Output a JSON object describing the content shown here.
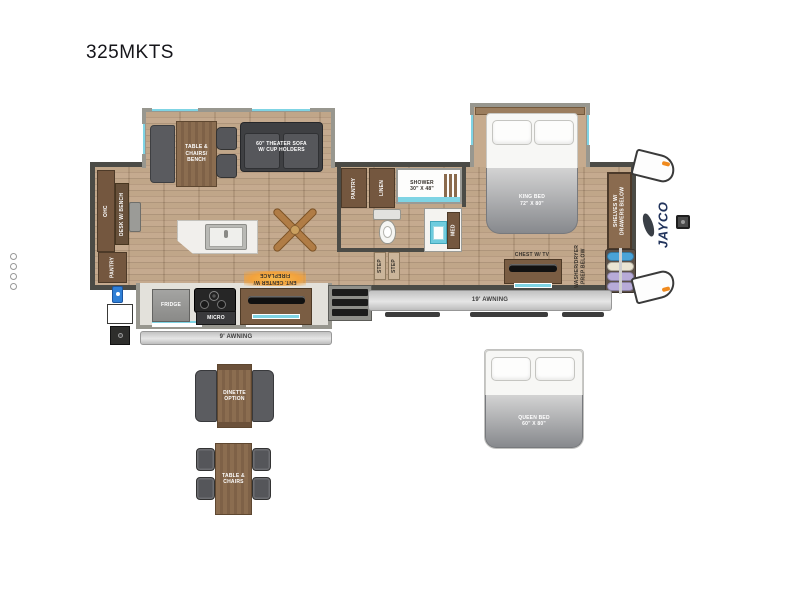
{
  "title": "325MKTS",
  "plan": {
    "living_slide": {
      "table_label": "TABLE &\nCHAIRS/\nBENCH",
      "sofa_label": "60\" THEATER SOFA\nW/ CUP HOLDERS"
    },
    "rear": {
      "ohc_label": "OHC",
      "desk_label": "DESK W/ BENCH",
      "pantry_label": "PANTRY"
    },
    "kitchen": {
      "fridge_label": "FRIDGE",
      "micro_label": "MICRO",
      "ent_center_label": "ENT. CENTER W/\nFIREPLACE",
      "awning_label": "9' AWNING"
    },
    "bath": {
      "pantry_label": "PANTRY",
      "linen_label": "LINEN",
      "shower_label": "SHOWER\n30\" X 48\"",
      "med_label": "MED",
      "step_label": "STEP"
    },
    "bedroom": {
      "king_bed_label": "KING BED\n72\" X 80\"",
      "chest_label": "CHEST W/ TV",
      "washer_label": "WASHER/DRYER\nPREP BELOW",
      "closet_label": "SHELVES W/\nDRAWERS BELOW"
    },
    "awning_label": "19' AWNING",
    "brand": "JAYCO"
  },
  "options": {
    "dinette_label": "DINETTE\nOPTION",
    "table_chairs_label": "TABLE &\nCHAIRS",
    "queen_bed_label": "QUEEN BED\n60\" X 80\""
  },
  "colors": {
    "floor_wood": "#b89c80",
    "wall": "#4b4b46",
    "slide_trim": "#98978f",
    "cabinet_brown": "#74573f",
    "table_wood": "#8b6d50",
    "sofa_gray": "#3f4043",
    "accent_teal": "#7fd4e4",
    "awning_gray": "#cfcfcf",
    "fireplace_glow": "#f2a23c",
    "handle_blue": "#2f7fd6",
    "tank_blue": "#4aa3d8",
    "tank_lavender": "#b7abd8",
    "brand_navy": "#22345c"
  }
}
